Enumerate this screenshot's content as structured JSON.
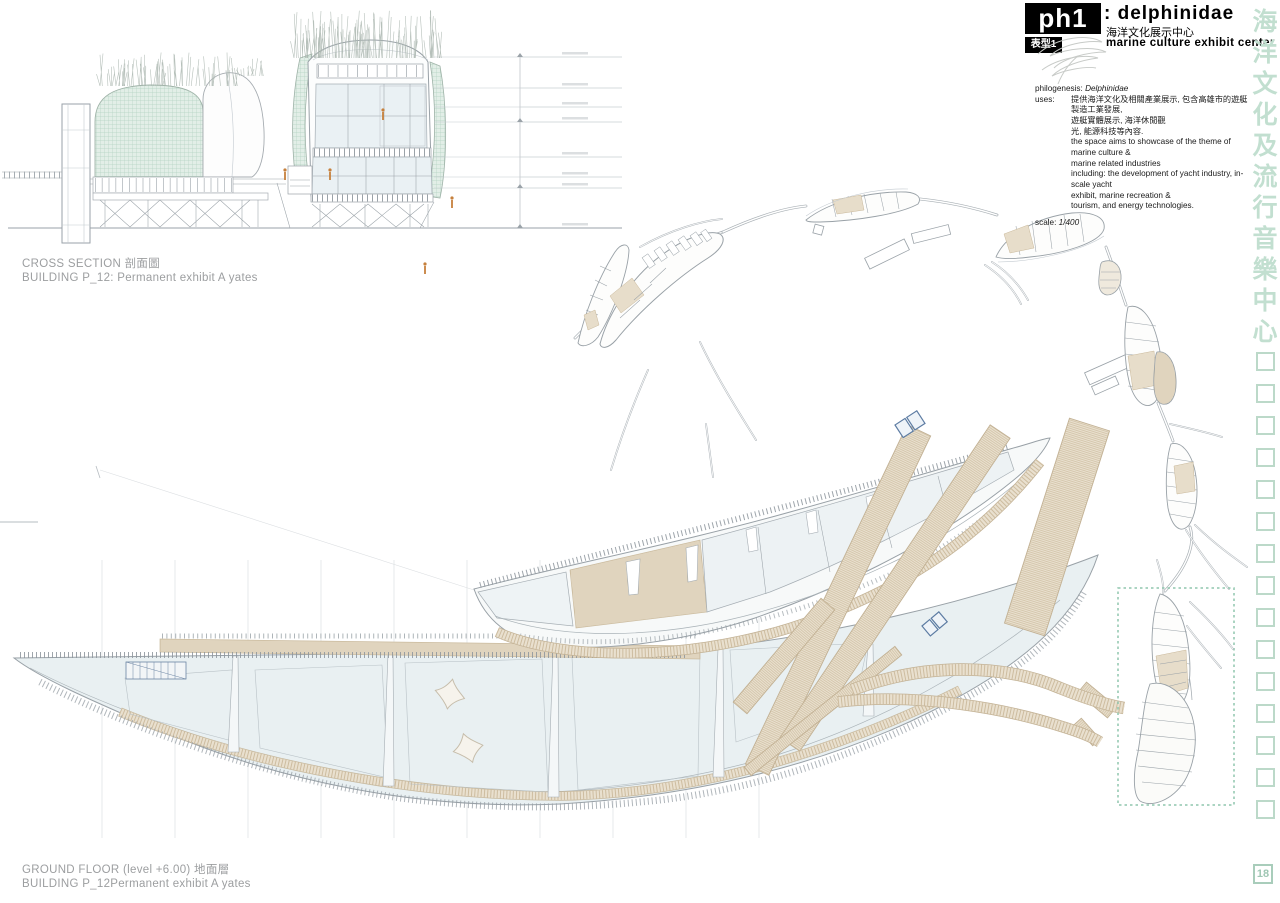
{
  "title_block": {
    "code": "ph1",
    "subcode": "表型1",
    "name": ": delphinidae",
    "name_zh": "海洋文化展示中心",
    "subtitle": "marine culture exhibit center",
    "philogenesis_label": "philogenesis:",
    "philogenesis_value": "Delphinidae",
    "uses_label": "uses:",
    "uses_lines": [
      "提供海洋文化及相關產業展示, 包含高雄市的遊艇製造工業發展,",
      "遊艇實體展示, 海洋休閒觀",
      "光, 能源科技等內容.",
      "the space aims to showcase of the theme of marine culture &",
      "marine related industries",
      "including: the development of yacht industry, in-scale yacht",
      "exhibit, marine recreation &",
      "tourism, and energy technologies."
    ],
    "scale_label": "scale:",
    "scale_value": "1/400"
  },
  "captions": {
    "cross_section_line1": "CROSS SECTION 剖面圖",
    "cross_section_line2": "BUILDING P_12: Permanent exhibit A yates",
    "ground_floor_line1": "GROUND FLOOR  (level +6.00) 地面層",
    "ground_floor_line2": "BUILDING P_12Permanent exhibit A yates"
  },
  "margin": {
    "chars": [
      "海",
      "洋",
      "文",
      "化",
      "及",
      "流",
      "行",
      "音",
      "樂",
      "中",
      "心"
    ],
    "page_number": "18"
  },
  "colors": {
    "facade_green_fill": "#e2eee7",
    "facade_green_line": "#b4d2c2",
    "deck_tan_fill": "#eae1d0",
    "deck_tan_line": "#cdbc9f",
    "glass_blue": "#e9f0f2",
    "margin_teal": "#bcd9c9",
    "figure_orange": "#c6803c",
    "drawing_gray": "#9aa2a8",
    "caption_gray": "#9c9ea0"
  }
}
